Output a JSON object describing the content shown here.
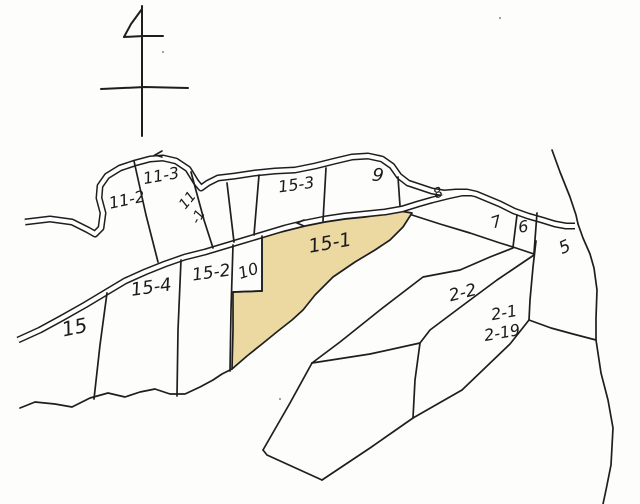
{
  "map": {
    "kind": "hand-drawn cadastral parcel map",
    "background": "#fdfdfc",
    "ink": "#1e1e1e",
    "road_fill": "#ffffff",
    "highlight_fill": "#ecd9a2",
    "highlighted_parcel": "15-1",
    "labels": [
      {
        "id": "parcel-label-11-2",
        "text": "11-2",
        "x": 128,
        "y": 205,
        "rot": -12,
        "fs": 16
      },
      {
        "id": "parcel-label-11-3",
        "text": "11-3",
        "x": 162,
        "y": 181,
        "rot": -10,
        "fs": 16
      },
      {
        "id": "parcel-label-11-1-a",
        "text": "11",
        "x": 191,
        "y": 203,
        "rot": -50,
        "fs": 14
      },
      {
        "id": "parcel-label-11-1-b",
        "text": "-1",
        "x": 202,
        "y": 219,
        "rot": -60,
        "fs": 14
      },
      {
        "id": "parcel-label-15-3",
        "text": "15-3",
        "x": 297,
        "y": 190,
        "rot": -8,
        "fs": 16
      },
      {
        "id": "parcel-label-9",
        "text": "9",
        "x": 377,
        "y": 181,
        "rot": 8,
        "fs": 18
      },
      {
        "id": "parcel-label-8",
        "text": "8",
        "x": 440,
        "y": 197,
        "rot": -25,
        "fs": 14
      },
      {
        "id": "parcel-label-7",
        "text": "7",
        "x": 498,
        "y": 227,
        "rot": -18,
        "fs": 16
      },
      {
        "id": "parcel-label-6",
        "text": "6",
        "x": 524,
        "y": 232,
        "rot": -8,
        "fs": 16
      },
      {
        "id": "parcel-label-5",
        "text": "5",
        "x": 567,
        "y": 252,
        "rot": -25,
        "fs": 17
      },
      {
        "id": "parcel-label-15-1",
        "text": "15-1",
        "x": 331,
        "y": 249,
        "rot": -10,
        "fs": 19
      },
      {
        "id": "parcel-label-15-2",
        "text": "15-2",
        "x": 212,
        "y": 278,
        "rot": -8,
        "fs": 17
      },
      {
        "id": "parcel-label-10",
        "text": "10",
        "x": 250,
        "y": 276,
        "rot": -18,
        "fs": 16
      },
      {
        "id": "parcel-label-15-4",
        "text": "15-4",
        "x": 152,
        "y": 293,
        "rot": -8,
        "fs": 18
      },
      {
        "id": "parcel-label-15",
        "text": "15",
        "x": 76,
        "y": 334,
        "rot": -12,
        "fs": 20
      },
      {
        "id": "parcel-label-2-2",
        "text": "2-2",
        "x": 464,
        "y": 298,
        "rot": -14,
        "fs": 17
      },
      {
        "id": "parcel-label-2-1",
        "text": "2-1",
        "x": 505,
        "y": 318,
        "rot": -10,
        "fs": 16
      },
      {
        "id": "parcel-label-2-19",
        "text": "2-19",
        "x": 503,
        "y": 338,
        "rot": -10,
        "fs": 16
      }
    ],
    "north_arrow": [
      "142,6 142,70 142,136",
      "101,89 145,87 188,88",
      "142,9 131,24 124,37",
      "124,37 144,36 163,36"
    ],
    "roads": [
      {
        "id": "road-upper",
        "points": "25,222 50,219 72,222 88,230 95,234 101,228 103,213 99,198 100,186 107,176 120,168 135,163 150,159 163,158 176,161 188,169 196,182 201,188 208,183 218,178 235,176 255,173 275,171 295,170 315,166 335,161 352,157 368,156 382,159 392,166 399,176 408,183 420,187 432,191 444,193 456,192 467,192 476,194 488,199 500,204 514,211 528,216 542,220 555,224 566,226 575,226"
      },
      {
        "id": "road-lower",
        "points": "18,340 40,330 62,318 85,305 105,293 125,281 145,272 165,264 185,257 205,252 225,246 245,240 265,234 285,228 305,223 325,219 345,216 365,214 385,212 402,209 418,204 432,200 448,196 462,193 472,193"
      }
    ],
    "highlight_polygon": "263,236 285,231 305,226 325,222 345,219 365,217 385,214 400,211 412,213 403,227 390,240 375,250 355,262 333,277 315,295 303,310 292,320 278,331 262,344 247,356 232,369 233,330 233,292 262,291 262,236",
    "boundaries": [
      {
        "id": "edge-right-upper",
        "points": "552,150 560,172 570,197 576,215 578,224"
      },
      {
        "id": "edge-right-lower",
        "points": "578,224 583,238 590,254 594,268 597,290 596,318 596,340 601,373 608,400 613,428 611,465 606,490 603,504"
      },
      {
        "id": "edge-strip76-bottom",
        "points": "412,215 440,224 470,233 500,243 513,247 534,254"
      },
      {
        "id": "divider-7-6",
        "points": "517,215 513,247"
      },
      {
        "id": "edge-6-right",
        "points": "537,213 534,253"
      },
      {
        "id": "edge-5-left",
        "points": "536,241 533,267 530,300 529,320"
      },
      {
        "id": "edge-5-bottom",
        "points": "529,320 551,328 573,334 596,340"
      },
      {
        "id": "edge-2-2-top",
        "points": "513,248 490,257 460,270 423,277 380,310 340,342 312,363"
      },
      {
        "id": "edge-2-2-bottom",
        "points": "534,255 497,280 462,306 430,330 420,343"
      },
      {
        "id": "edge-polygon-top",
        "points": "420,343 370,354 312,363"
      },
      {
        "id": "edge-2-1-left",
        "points": "420,343 415,380 413,418"
      },
      {
        "id": "edge-2-1-bottom",
        "points": "413,418 462,390 510,344 529,320"
      },
      {
        "id": "edge-polygon-left",
        "points": "312,363 290,403 263,450"
      },
      {
        "id": "edge-polygon-bottom",
        "points": "263,450 267,455 322,480"
      },
      {
        "id": "edge-polygon-se",
        "points": "322,480 370,448 413,418"
      },
      {
        "id": "edge-coast-wavy",
        "points": "20,408 35,402 55,404 72,407 90,398 108,393 125,397 140,392 155,389 170,394 185,394 200,387 213,380 222,374 232,369"
      },
      {
        "id": "divider-15-154",
        "points": "107,293 100,345 94,399"
      },
      {
        "id": "divider-154-152",
        "points": "181,260 178,330 177,396"
      },
      {
        "id": "divider-152-151",
        "points": "233,245 231,310 230,371"
      },
      {
        "id": "edge-10-bottom",
        "points": "233,292 262,291"
      },
      {
        "id": "edge-10-right",
        "points": "262,236 262,291"
      },
      {
        "id": "divider-112-113",
        "points": "134,161 146,215 158,262"
      },
      {
        "id": "divider-113-111",
        "points": "191,172 204,220 213,248"
      },
      {
        "id": "divider-111-right",
        "points": "227,183 234,242"
      },
      {
        "id": "divider-153-left",
        "points": "259,175 254,235"
      },
      {
        "id": "divider-153-9",
        "points": "326,168 323,221"
      },
      {
        "id": "divider-9-right",
        "points": "398,177 400,206"
      }
    ],
    "ticks": [
      {
        "id": "road-tick-upper",
        "points": "162,151 155,155 162,157"
      },
      {
        "id": "road-tick-lower",
        "points": "304,220 297,223 304,226"
      }
    ],
    "specks": [
      {
        "x": 163,
        "y": 52
      },
      {
        "x": 500,
        "y": 18
      },
      {
        "x": 280,
        "y": 399
      }
    ]
  }
}
